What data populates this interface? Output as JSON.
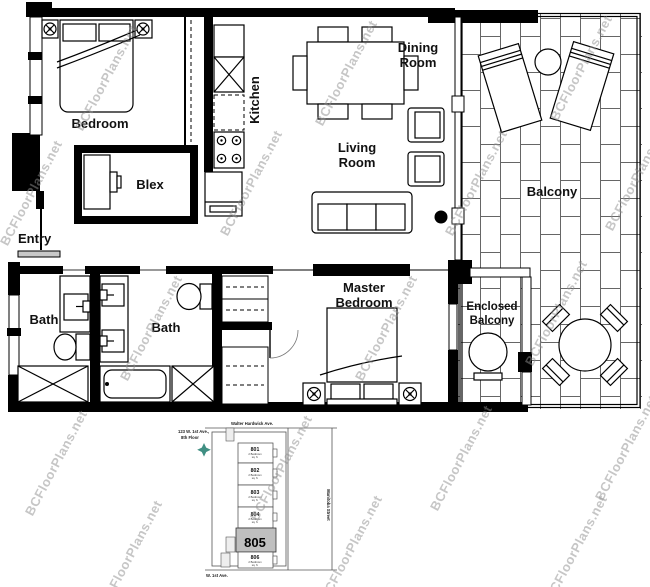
{
  "watermark": {
    "text": "BCFloorPlans.net"
  },
  "rooms": {
    "bedroom": "Bedroom",
    "blex": "Blex",
    "kitchen": "Kitchen",
    "dining_line1": "Dining",
    "dining_line2": "Room",
    "living_line1": "Living",
    "living_line2": "Room",
    "balcony": "Balcony",
    "entry": "Entry",
    "bath_left": "Bath",
    "bath_right": "Bath",
    "master_line1": "Master",
    "master_line2": "Bedroom",
    "enclosed_line1": "Enclosed",
    "enclosed_line2": "Balcony"
  },
  "site_plan": {
    "street_top": "Walter Hardwick Ave.",
    "street_bottom": "W. 1st Ave.",
    "street_right": "Manitoba Street",
    "address_line1": "123 W. 1st Ave.,",
    "address_line2": "8th Floor",
    "highlighted_unit": "805",
    "units": [
      {
        "number": "801",
        "caption_line1": "2 Bedroom",
        "caption_line2": "sq. ft."
      },
      {
        "number": "802",
        "caption_line1": "2 Bedroom",
        "caption_line2": "sq. ft."
      },
      {
        "number": "803",
        "caption_line1": "2 Bedroom",
        "caption_line2": "sq. ft."
      },
      {
        "number": "804",
        "caption_line1": "2 Bedroom",
        "caption_line2": "sq. ft."
      },
      {
        "number": "805",
        "caption_line1": "",
        "caption_line2": ""
      },
      {
        "number": "806",
        "caption_line1": "2 Bedroom",
        "caption_line2": "sq. ft."
      }
    ]
  },
  "colors": {
    "wall": "#000000",
    "brick_line": "#666666",
    "watermark": "#8f8f8f",
    "highlight": "#c0c0c0",
    "compass": "#1e7b6d"
  }
}
